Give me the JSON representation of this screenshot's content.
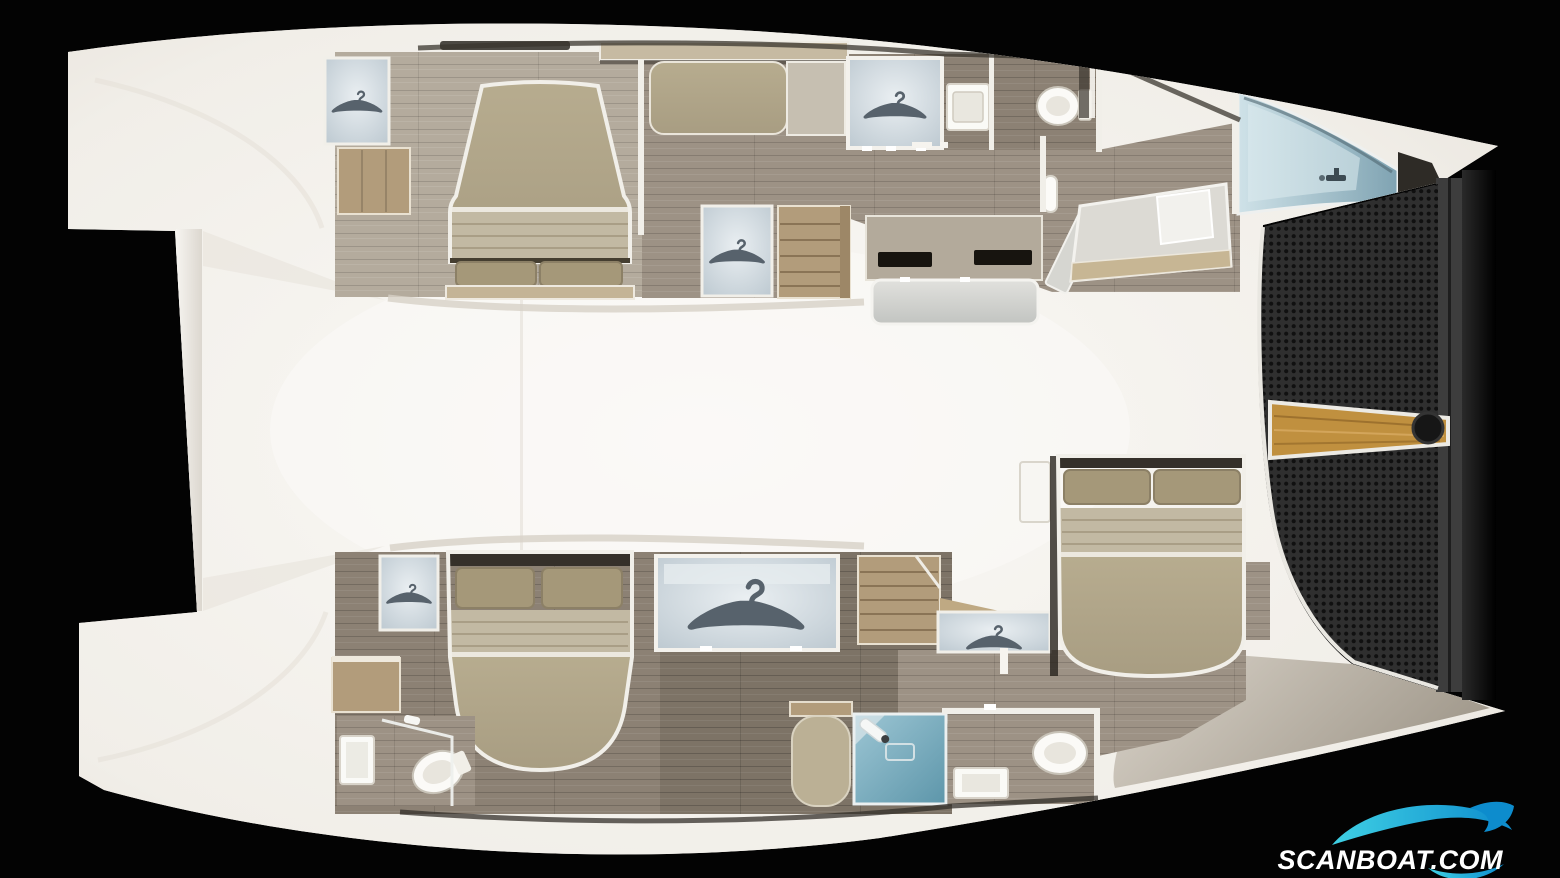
{
  "canvas": {
    "width": 1560,
    "height": 878
  },
  "watermark": {
    "text": "SCANBOAT.COM",
    "icon": "wave-swoosh-logo"
  },
  "colors": {
    "background": "#030303",
    "hull_white": "#f3f1ec",
    "deck_cream": "#efece6",
    "wood_floor_light": "#b4ab9d",
    "wood_floor_mid": "#9d9285",
    "wood_floor_dark": "#8c8174",
    "wood_floor_deep": "#7d7366",
    "furniture_wood": "#b29c7b",
    "shelf_wood": "#c6baa2",
    "bed_khaki": "#b1a68a",
    "bed_ribbed": "#c2b9a3",
    "pillow": "#a59879",
    "headboard_dark": "#35302a",
    "cushion_gray": "#d6d6d2",
    "glass_panel": "#c7d1d7",
    "glass_blue": "#a9c6d2",
    "shower_teal": "#74aabd",
    "trampoline_base": "#2f2f2f",
    "trampoline_dot": "#101010",
    "beam_gray": "#3d3d3d",
    "bowsprit_wood": "#c0903f",
    "white_trim": "#f1efe9",
    "logo_teal_light": "#3fd0e4",
    "logo_teal_dark": "#0d8ccd"
  },
  "scene": {
    "type": "yacht-deck-plan-render",
    "view": "top-down, bow to the right",
    "vessel": "sailing catamaran, four cabin layout",
    "port_hull": {
      "aft_cabin": [
        "double-bed-head-inboard",
        "two-pillows",
        "wardrobe-with-hanger",
        "drawer-chest",
        "settee",
        "storage-shelf"
      ],
      "midship": [
        "shower-cabin-with-hanger",
        "washbasin-vanity",
        "toilet-room",
        "corridor-wardrobe-with-hanger",
        "companionway-stairs"
      ],
      "forward": [
        "desk-with-two-drawers",
        "bench-seat",
        "angled-single-berth-with-pillow",
        "tilted-door-panel",
        "glass-forepeak-hatch-with-faucet"
      ]
    },
    "starboard_hull": {
      "aft_cabin": [
        "double-bed-head-inboard",
        "two-pillows",
        "wardrobe-with-hanger",
        "vanity-chest",
        "bathroom-mirror",
        "toilet",
        "glass-shower-partition"
      ],
      "midship": [
        "large-shower-cabin-with-hanger",
        "chaise-seat",
        "companionway-stairs",
        "corridor-wardrobe-with-hanger",
        "teal-shower-room",
        "toilet-room-with-washbasin"
      ],
      "forward": [
        "double-bed-athwartships",
        "two-pillows",
        "nightstand",
        "foredeck"
      ]
    },
    "bow": [
      "trampoline-net",
      "bow-crossbeam",
      "wooden-bowsprit",
      "anchor-roller-fitting"
    ]
  }
}
